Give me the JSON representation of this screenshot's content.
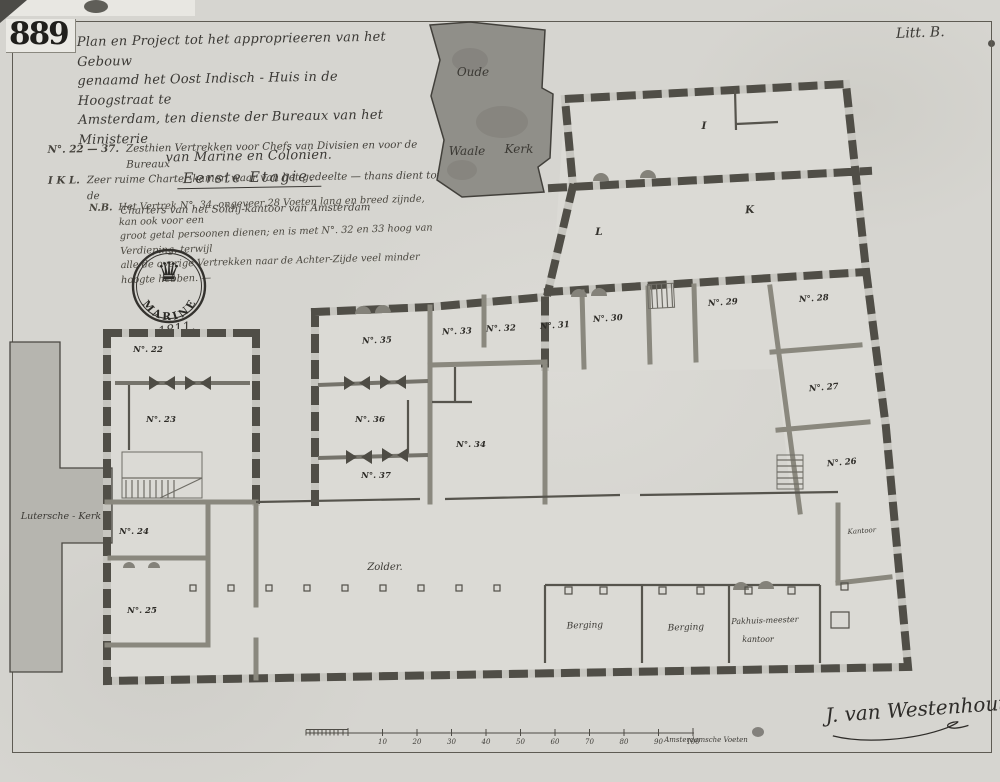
{
  "page": {
    "archive_number": "889",
    "litt_label": "Litt. B.",
    "signature": "J. van Westenhout",
    "colors": {
      "paper": "#d6d5d0",
      "ink": "#35332f",
      "wall_dark": "#504e47",
      "church_dark": "#908f89",
      "church_light": "#b6b5af"
    }
  },
  "title_block": {
    "line1": "Plan en Project tot het approprieeren van het Gebouw",
    "line2": "genaamd het Oost Indisch - Huis in de Hoogstraat te",
    "line3": "Amsterdam, ten dienste der Bureaux van het Ministerie",
    "line4": "van Marine en Colonien.",
    "floor_label": "Eerste  Etagie."
  },
  "legend": {
    "rooms_label": "N°. 22 — 37.",
    "rooms_text": "Zesthien Vertrekken voor Chefs van Divisien en voor de Bureaux",
    "ikl_label": "I K L.",
    "ikl_text": "Zeer ruime Charter-kamer, waar van het gedeelte — thans dient tot de",
    "ikl_text2": "Charters van het Soldij-kantoor van Amsterdam",
    "nb_label": "N.B.",
    "nb_line1": "Het Vertrek N°. 34, ongeveer 28 Voeten lang en breed zijnde, kan ook voor een",
    "nb_line2": "groot getal persoonen dienen; en is met N°. 32 en 33 hoog van Verdieping, terwijl",
    "nb_line3": "alle de overige Vertrekken naar de Achter-Zijde veel minder hoogte hebben. —"
  },
  "seal": {
    "text": "MARINE",
    "icon": "crown-icon",
    "year": "1811."
  },
  "map_labels": {
    "oude": "Oude",
    "waale": "Waale",
    "kerk": "Kerk",
    "lutersche_kerk": "Lutersche - Kerk",
    "zolder": "Zolder.",
    "kantoor": "Kantoor",
    "berging1": "Berging",
    "berging2": "Berging",
    "pakhuis_line1": "Pakhuis-meester",
    "pakhuis_line2": "kantoor",
    "letter_i": "I",
    "letter_k": "K",
    "letter_l": "L"
  },
  "rooms": [
    {
      "label": "N°. 22"
    },
    {
      "label": "N°. 23"
    },
    {
      "label": "N°. 24"
    },
    {
      "label": "N°. 25"
    },
    {
      "label": "N°. 26"
    },
    {
      "label": "N°. 27"
    },
    {
      "label": "N°. 28"
    },
    {
      "label": "N°. 29"
    },
    {
      "label": "N°. 30"
    },
    {
      "label": "N°. 31"
    },
    {
      "label": "N°. 32"
    },
    {
      "label": "N°. 33"
    },
    {
      "label": "N°. 34"
    },
    {
      "label": "N°. 35"
    },
    {
      "label": "N°. 36"
    },
    {
      "label": "N°. 37"
    }
  ],
  "scalebar": {
    "ticks": [
      "10",
      "20",
      "30",
      "40",
      "50",
      "60",
      "70",
      "80",
      "90"
    ],
    "hundred": "100",
    "unit_label": "Amsterdamsche Voeten"
  }
}
